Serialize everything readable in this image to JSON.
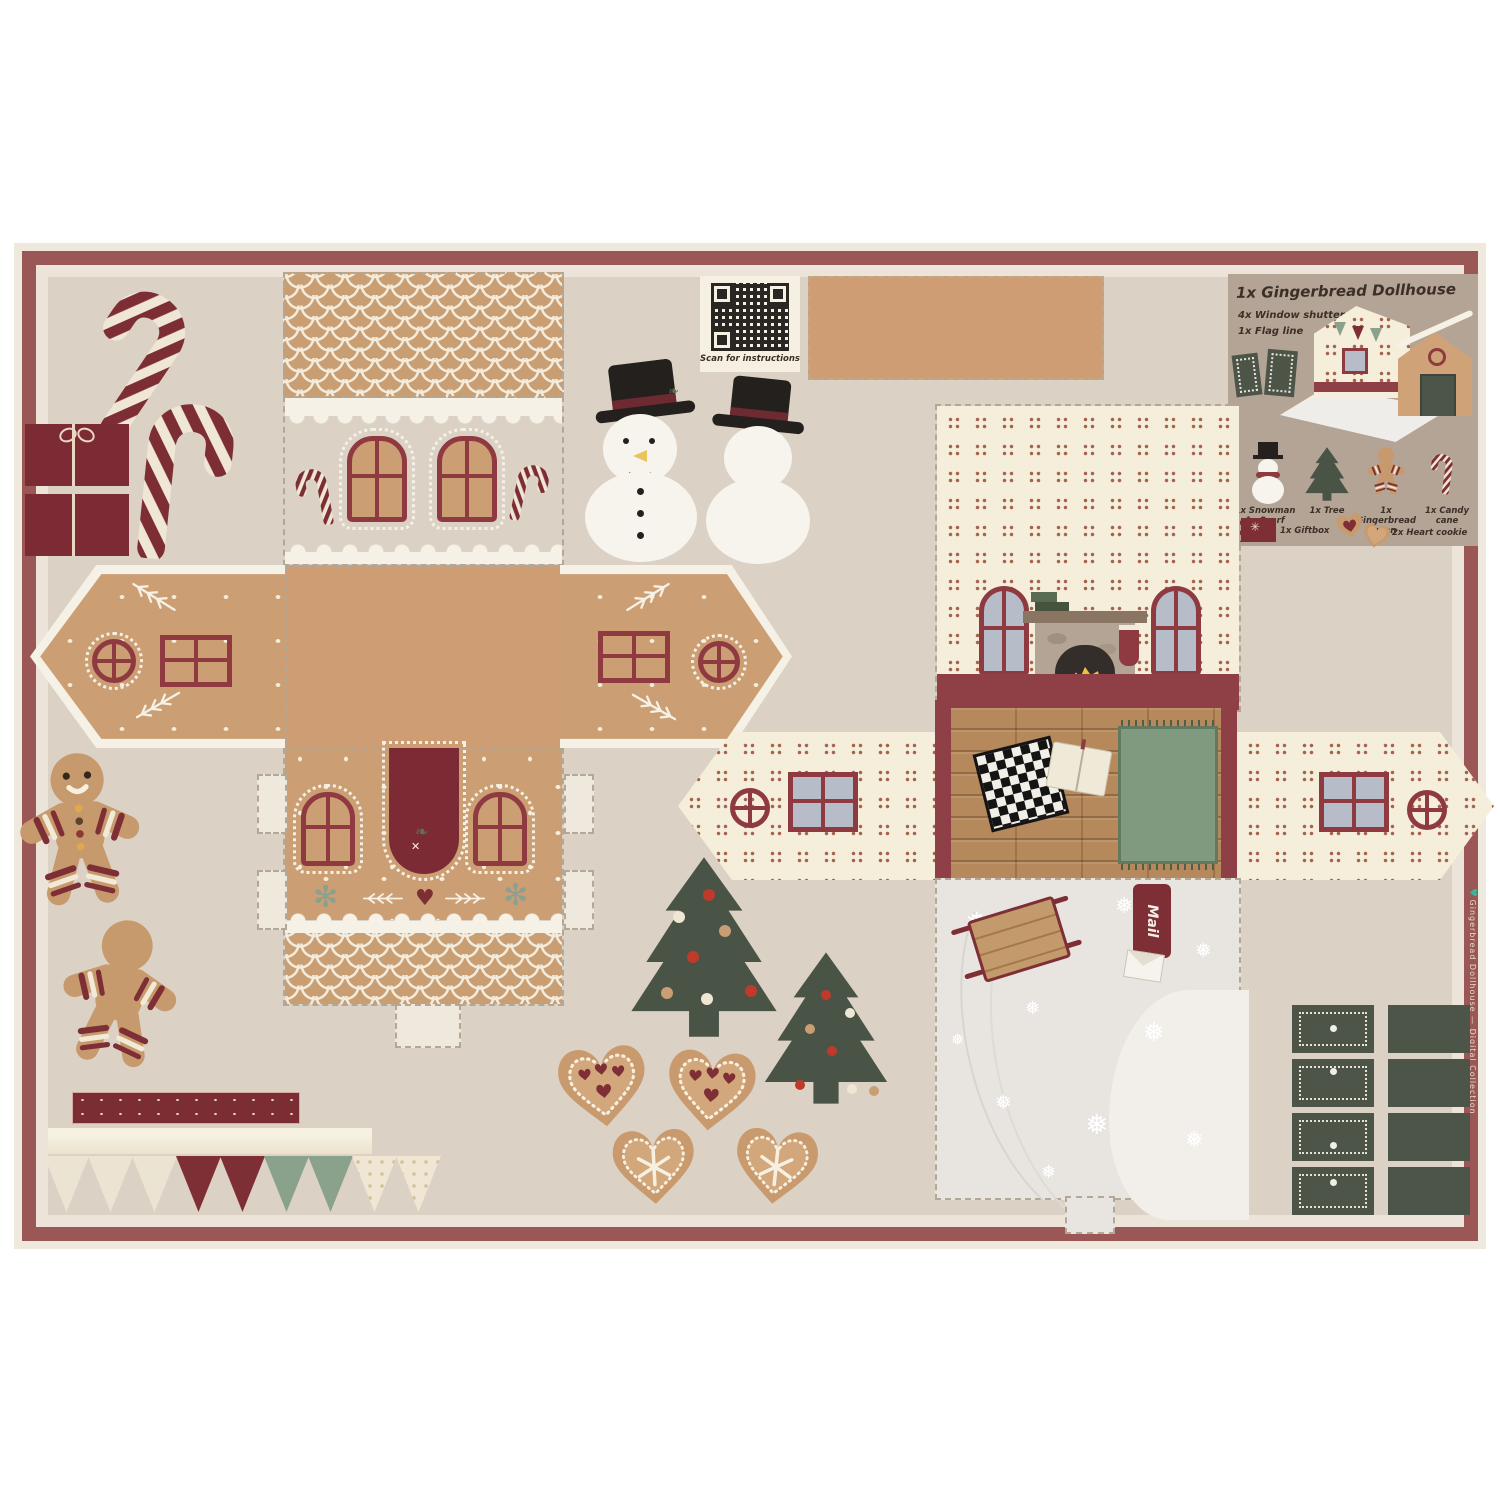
{
  "palette": {
    "background": "#dcd1c5",
    "border_maroon": "#9b5656",
    "gingerbread_tan": "#cb9e73",
    "icing_cream": "#f6f1e6",
    "accent_dark_red": "#7e2f36",
    "window_red": "#8e3a40",
    "pine_green": "#4d5548",
    "sage_green": "#8aa28c",
    "wallpaper_cream": "#f5eedb",
    "snow_gray": "#e8e4e0"
  },
  "qr_card": {
    "caption": "Scan for instructions"
  },
  "legend": {
    "title": "1x Gingerbread Dollhouse",
    "subtitle_1": "4x Window shutters",
    "subtitle_2": "1x Flag line",
    "items": [
      {
        "label_line1": "1x Snowman",
        "label_line2": "1x Scarf"
      },
      {
        "label_line1": "1x Tree",
        "label_line2": ""
      },
      {
        "label_line1": "1x Gingerbread",
        "label_line2": "man"
      },
      {
        "label_line1": "1x Candy cane",
        "label_line2": ""
      }
    ],
    "extra_items": [
      {
        "label": "1x Giftbox"
      },
      {
        "label": "2x Heart cookie"
      }
    ]
  },
  "snow_base": {
    "mail_tag": "Mail"
  },
  "selvage": {
    "heart": "♥",
    "text": "Gingerbread Dollhouse — Digital Collection"
  }
}
